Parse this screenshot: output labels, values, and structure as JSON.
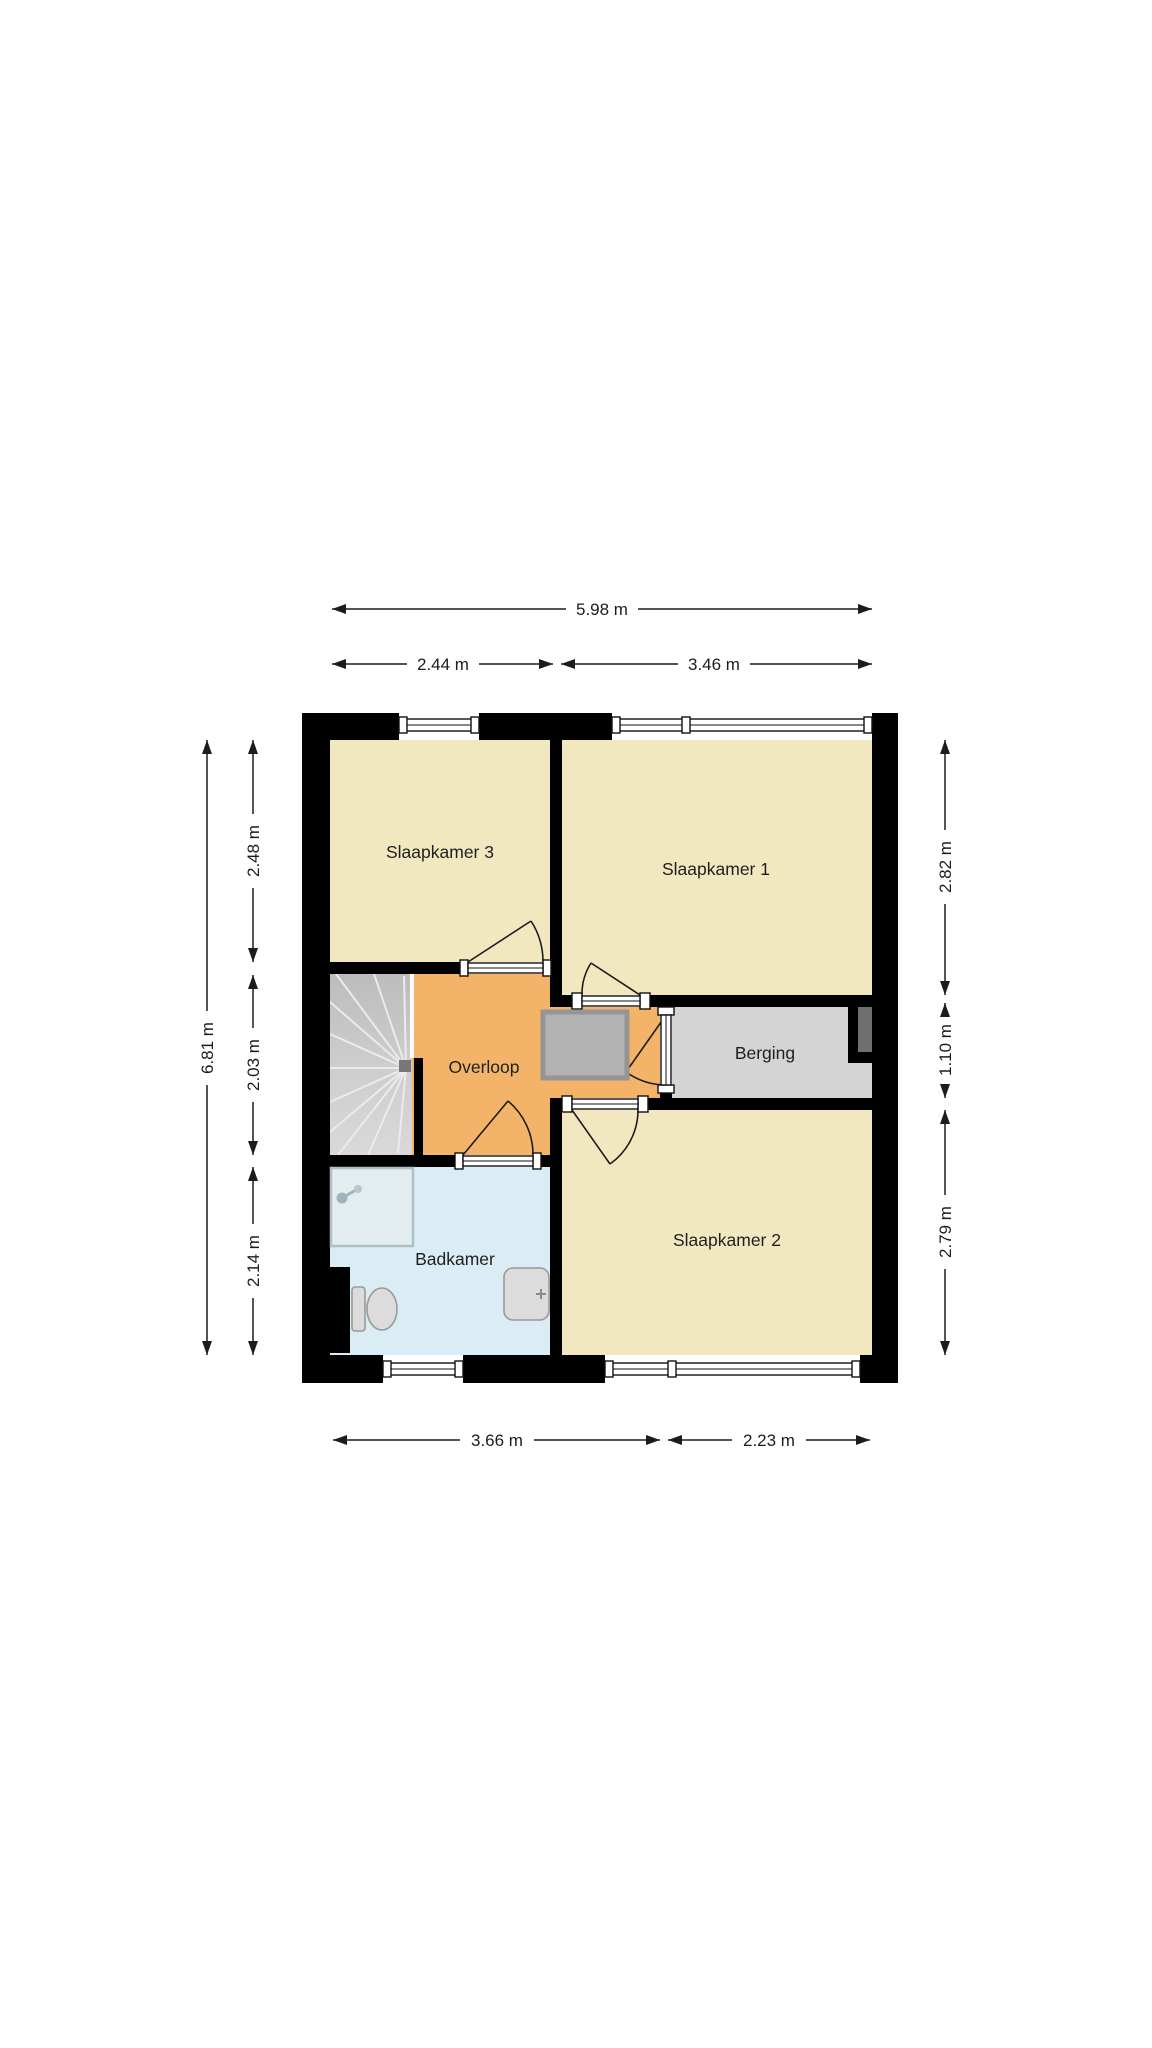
{
  "floorplan": {
    "rooms": [
      {
        "id": "slaapkamer-3",
        "label": "Slaapkamer 3"
      },
      {
        "id": "slaapkamer-1",
        "label": "Slaapkamer 1"
      },
      {
        "id": "overloop",
        "label": "Overloop"
      },
      {
        "id": "berging",
        "label": "Berging"
      },
      {
        "id": "badkamer",
        "label": "Badkamer"
      },
      {
        "id": "slaapkamer-2",
        "label": "Slaapkamer 2"
      }
    ],
    "dimensions": {
      "top": {
        "total": "5.98 m",
        "segments": [
          "2.44 m",
          "3.46 m"
        ]
      },
      "left": {
        "total": "6.81 m",
        "segments": [
          "2.48 m",
          "2.03 m",
          "2.14 m"
        ]
      },
      "right": {
        "segments": [
          "2.82 m",
          "1.10 m",
          "2.79 m"
        ]
      },
      "bottom": {
        "segments": [
          "3.66 m",
          "2.23 m"
        ]
      }
    },
    "colors": {
      "background": "#ffffff",
      "wall": "#000000",
      "bedroom": "#f2e8c0",
      "hallway": "#f3b469",
      "storage": "#d4d4d4",
      "bathroom": "#daecf4",
      "stairs": "#c9c9c9",
      "closet": "#b2b2b2",
      "duct": "#6f6f6f"
    }
  }
}
